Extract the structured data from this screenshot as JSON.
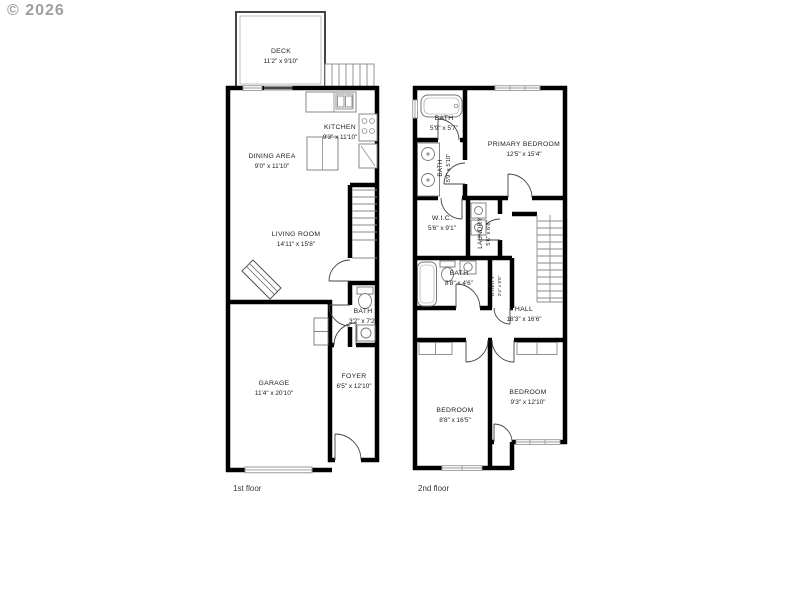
{
  "watermark": "© 2026",
  "colors": {
    "walls": "#000000",
    "background": "#ffffff",
    "fixture_lines": "#777777",
    "watermark_color": "#8f8f8f",
    "text_color": "#1c1c1c"
  },
  "floors": [
    {
      "label": "1st floor",
      "rooms": [
        {
          "name": "DECK",
          "dims": "11'2\" x 9'10\""
        },
        {
          "name": "DINING AREA",
          "dims": "9'0\" x 11'10\""
        },
        {
          "name": "KITCHEN",
          "dims": "9'3\" x 11'10\""
        },
        {
          "name": "LIVING ROOM",
          "dims": "14'11\" x 15'8\""
        },
        {
          "name": "BATH",
          "dims": "3'2\" x 7'2\""
        },
        {
          "name": "GARAGE",
          "dims": "11'4\" x 20'10\""
        },
        {
          "name": "FOYER",
          "dims": "6'5\" x 12'10\""
        }
      ]
    },
    {
      "label": "2nd floor",
      "rooms": [
        {
          "name": "BATH",
          "dims": "5'9\" x 5'7\""
        },
        {
          "name": "PRIMARY BEDROOM",
          "dims": "12'5\" x 15'4\""
        },
        {
          "name": "BATH",
          "dims": "5'9\" x 5'10\""
        },
        {
          "name": "W.I.C.",
          "dims": "5'6\" x 9'1\""
        },
        {
          "name": "LAUNDRY",
          "dims": "5'6\" x 6'6\""
        },
        {
          "name": "BATH",
          "dims": "8'8\" x 4'6\""
        },
        {
          "name": "UTILITY",
          "dims": "2'4\" x 5'5\""
        },
        {
          "name": "HALL",
          "dims": "18'3\" x 16'6\""
        },
        {
          "name": "BEDROOM",
          "dims": "8'8\" x 16'5\""
        },
        {
          "name": "BEDROOM",
          "dims": "9'3\" x 12'10\""
        }
      ]
    }
  ]
}
